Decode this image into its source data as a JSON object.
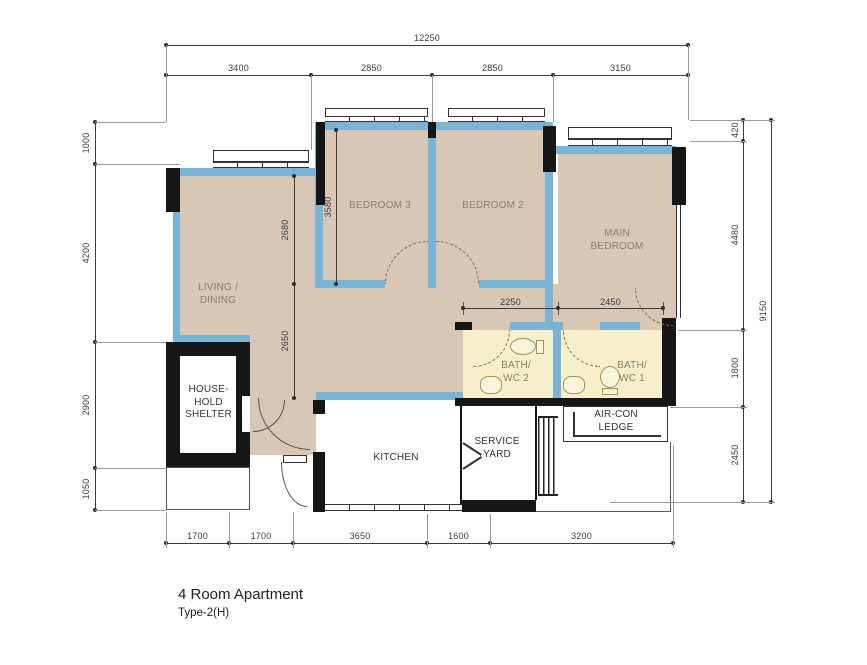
{
  "title": {
    "name": "4 Room Apartment",
    "type": "Type-2(H)"
  },
  "rooms": {
    "living": "LIVING /\nDINING",
    "bedroom3": "BEDROOM 3",
    "bedroom2": "BEDROOM 2",
    "main_bedroom": "MAIN\nBEDROOM",
    "household_shelter": "HOUSE-\nHOLD\nSHELTER",
    "kitchen": "KITCHEN",
    "service_yard": "SERVICE\nYARD",
    "aircon_ledge": "AIR-CON\nLEDGE",
    "bath_wc2": "BATH/\nWC 2",
    "bath_wc1": "BATH/\nWC 1"
  },
  "dims": {
    "overall_width": "12250",
    "overall_height": "9150",
    "top": [
      "3400",
      "2850",
      "2850",
      "3150"
    ],
    "left": [
      "1000",
      "4200",
      "2900",
      "1050"
    ],
    "right": [
      "420",
      "4480",
      "1800",
      "2450"
    ],
    "bottom": [
      "1700",
      "1700",
      "3650",
      "1600",
      "3200"
    ],
    "interior": {
      "living_upper": "2680",
      "bedroom3_depth": "3580",
      "living_lower": "2650",
      "bath2_width": "2250",
      "bath1_width": "2450"
    }
  },
  "colors": {
    "wall_blue": "#76b4d8",
    "floor_tan": "#d9c7b5",
    "bath_yellow": "#f6efca",
    "wall_black": "#161616"
  }
}
